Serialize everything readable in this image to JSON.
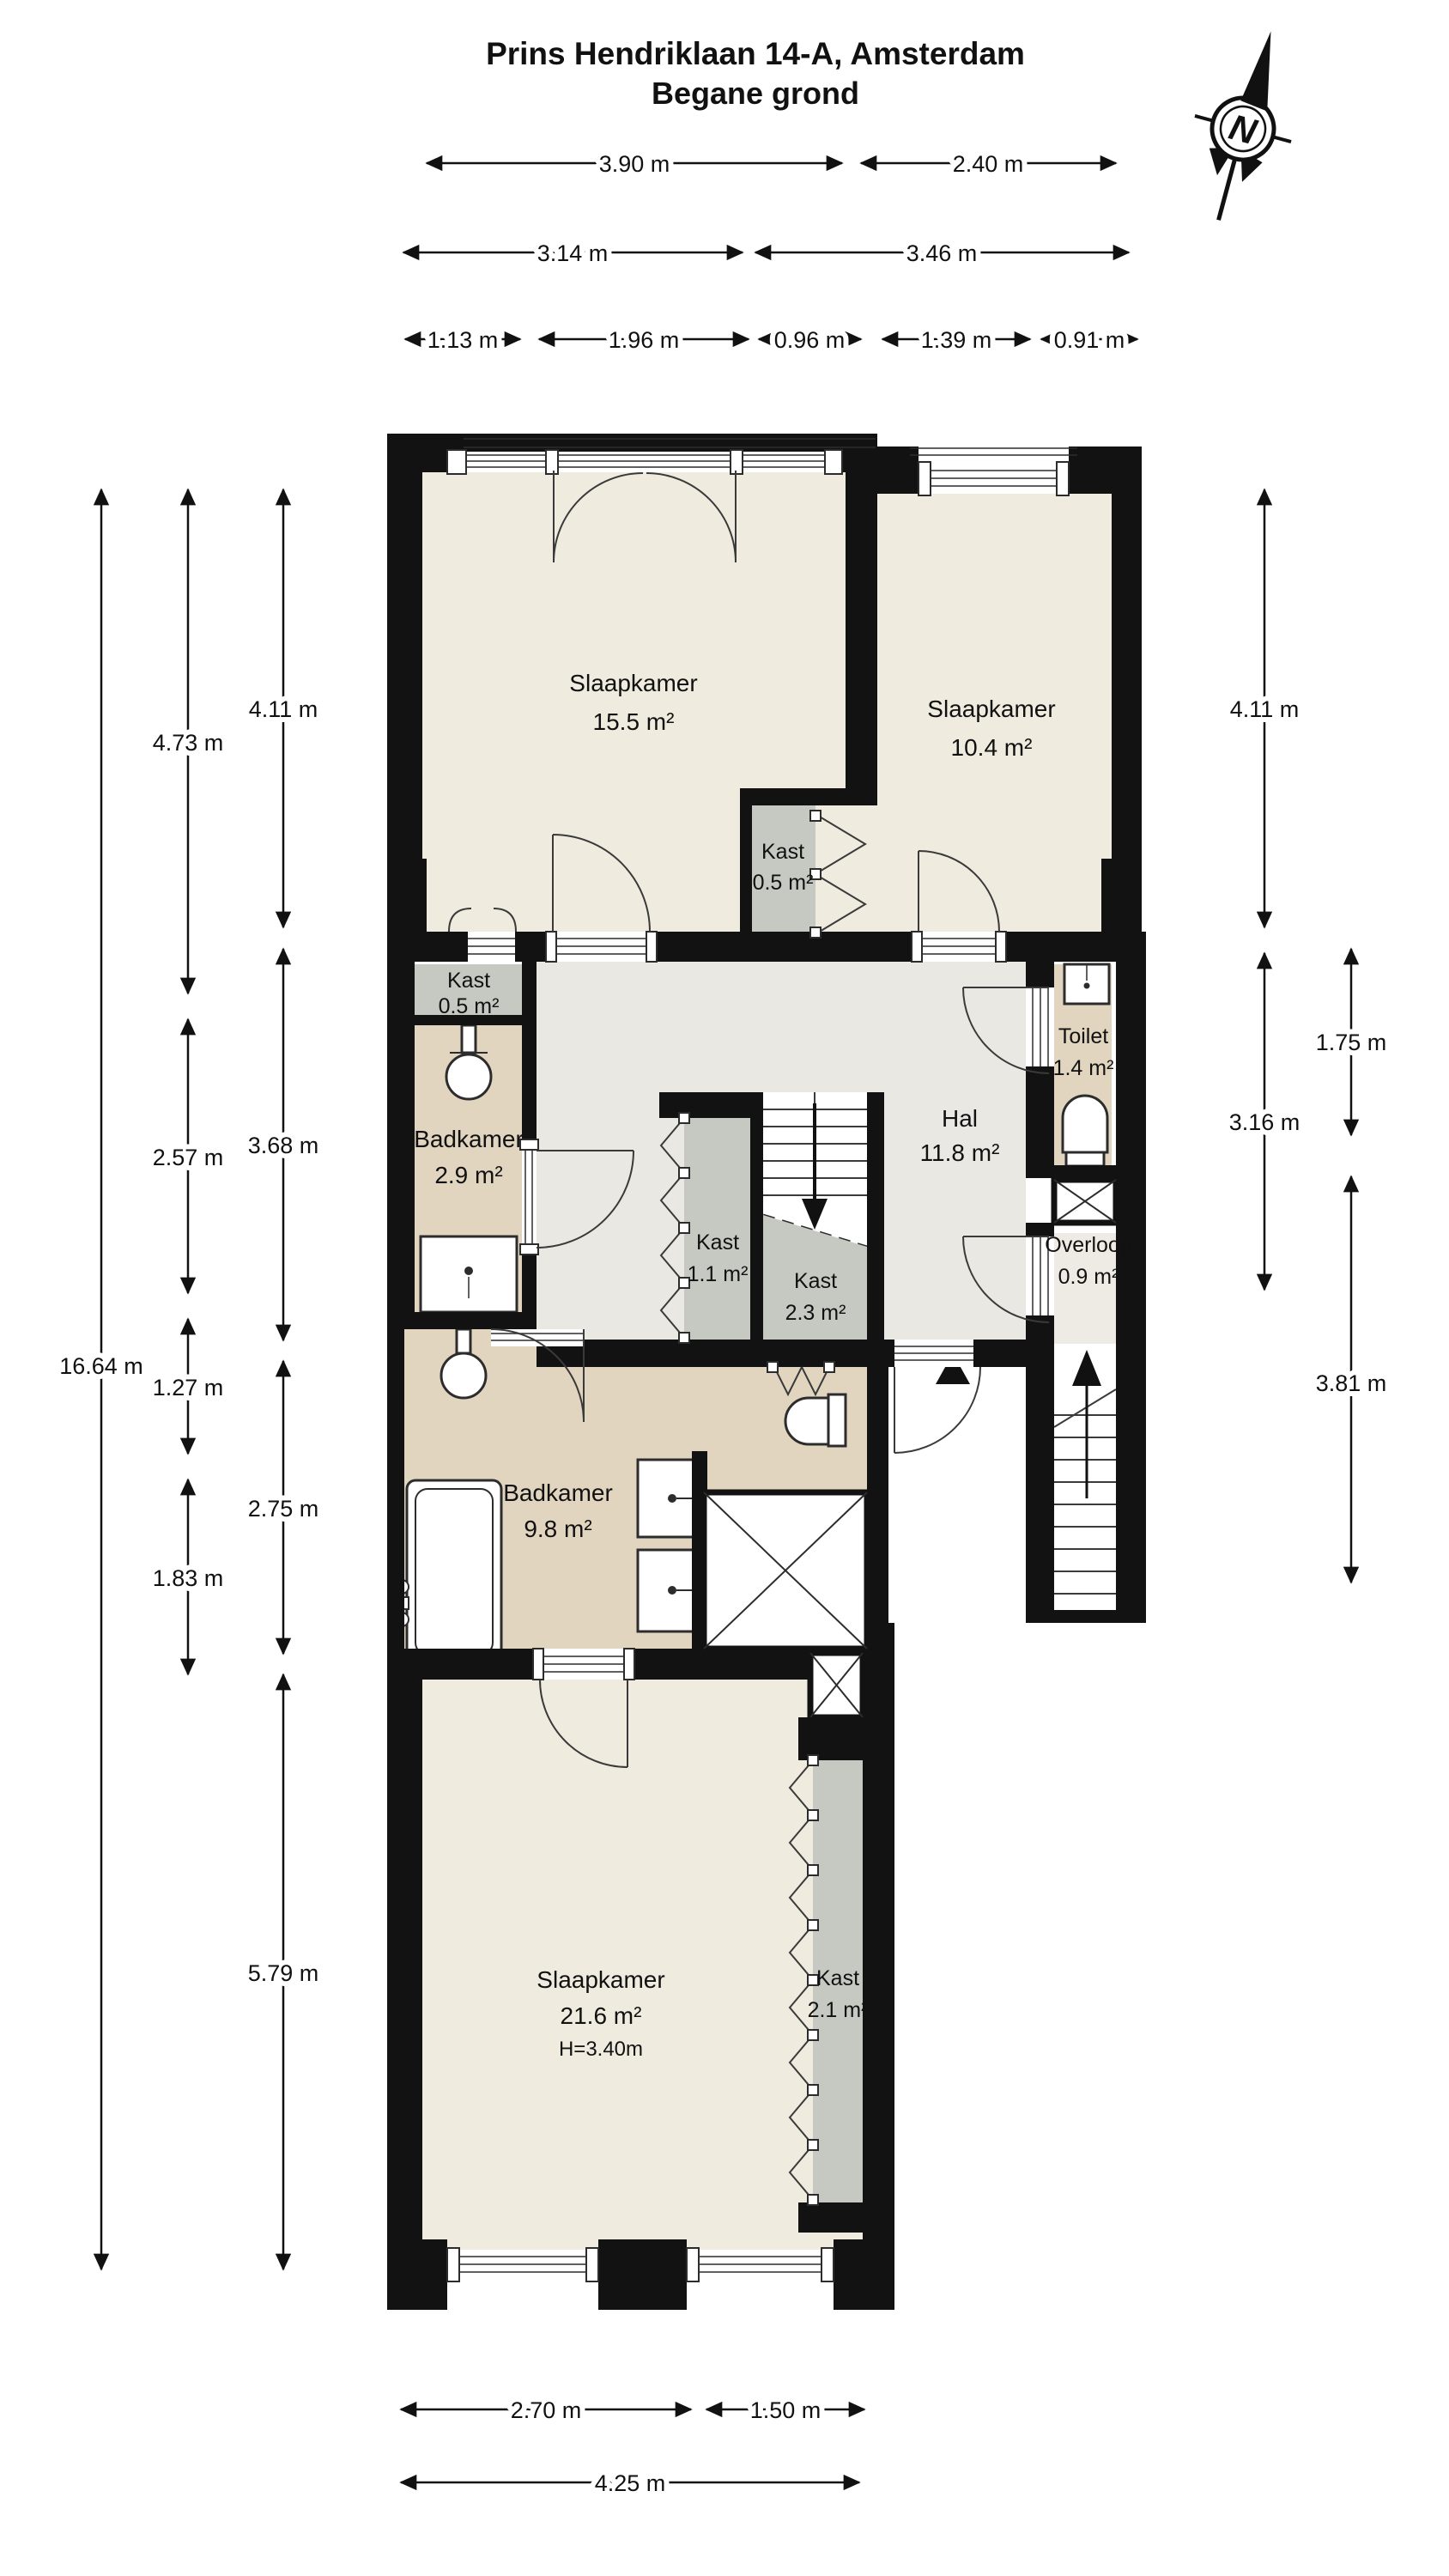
{
  "title": {
    "line1": "Prins Hendriklaan 14-A, Amsterdam",
    "line2": "Begane grond"
  },
  "compass": {
    "label": "N"
  },
  "rooms": [
    {
      "id": "slaapkamer-voor",
      "name": "Slaapkamer",
      "area": "15.5 m²"
    },
    {
      "id": "slaapkamer-rechts",
      "name": "Slaapkamer",
      "area": "10.4 m²"
    },
    {
      "id": "kast-midden",
      "name": "Kast",
      "area": "0.5 m²"
    },
    {
      "id": "kast-links",
      "name": "Kast",
      "area": "0.5 m²"
    },
    {
      "id": "badkamer-klein",
      "name": "Badkamer",
      "area": "2.9 m²"
    },
    {
      "id": "hal",
      "name": "Hal",
      "area": "11.8 m²"
    },
    {
      "id": "kast-11",
      "name": "Kast",
      "area": "1.1 m²"
    },
    {
      "id": "kast-23",
      "name": "Kast",
      "area": "2.3 m²"
    },
    {
      "id": "toilet",
      "name": "Toilet",
      "area": "1.4 m²"
    },
    {
      "id": "overloop",
      "name": "Overloop",
      "area": "0.9 m²"
    },
    {
      "id": "badkamer-groot",
      "name": "Badkamer",
      "area": "9.8 m²"
    },
    {
      "id": "slaapkamer-achter",
      "name": "Slaapkamer",
      "area": "21.6 m²",
      "height": "H=3.40m"
    },
    {
      "id": "kast-21",
      "name": "Kast",
      "area": "2.1 m²"
    }
  ],
  "dimensions": {
    "top": [
      {
        "label": "3.90 m"
      },
      {
        "label": "2.40 m"
      },
      {
        "label": "3.14 m"
      },
      {
        "label": "3.46 m"
      },
      {
        "label": "1.13 m"
      },
      {
        "label": "1.96 m"
      },
      {
        "label": "0.96 m"
      },
      {
        "label": "1.39 m"
      },
      {
        "label": "0.91 m"
      }
    ],
    "left": [
      {
        "label": "16.64 m"
      },
      {
        "label": "4.73 m"
      },
      {
        "label": "2.57 m"
      },
      {
        "label": "1.27 m"
      },
      {
        "label": "1.83 m"
      },
      {
        "label": "4.11 m"
      },
      {
        "label": "3.68 m"
      },
      {
        "label": "2.75 m"
      },
      {
        "label": "5.79 m"
      }
    ],
    "right": [
      {
        "label": "4.11 m"
      },
      {
        "label": "3.16 m"
      },
      {
        "label": "1.75 m"
      },
      {
        "label": "3.81 m"
      }
    ],
    "bottom": [
      {
        "label": "2.70 m"
      },
      {
        "label": "1.50 m"
      },
      {
        "label": "4.25 m"
      }
    ]
  },
  "colors": {
    "wall": "#121212",
    "floor_bedroom": "#efebdf",
    "floor_hall": "#e9e8e2",
    "floor_bath": "#e1d5c0",
    "floor_closet": "#c6c8c2",
    "floor_landing": "#edebe4"
  }
}
